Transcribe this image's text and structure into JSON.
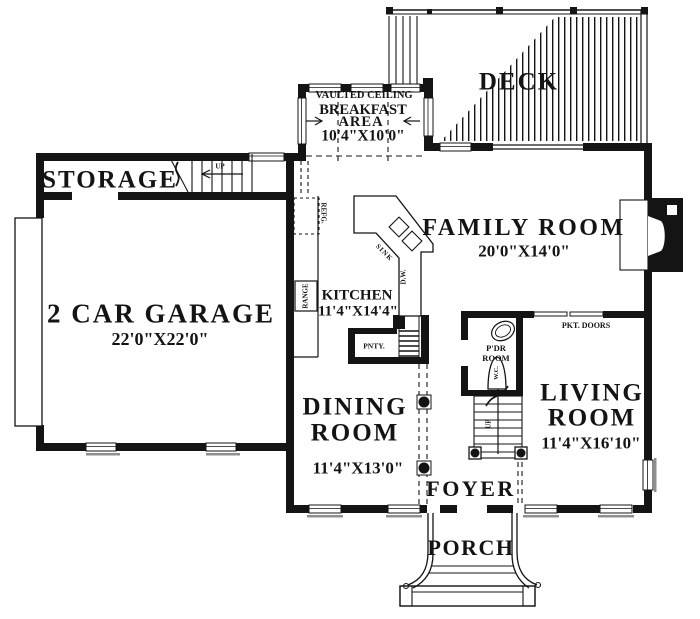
{
  "rooms": {
    "deck": {
      "name": "DECK"
    },
    "breakfast": {
      "note": "VAULTED CEILING",
      "name_line1": "BREAKFAST",
      "name_line2": "AREA",
      "dims": "10'4\"X10'0\""
    },
    "storage": {
      "name": "STORAGE"
    },
    "garage": {
      "name": "2 CAR GARAGE",
      "dims": "22'0\"X22'0\""
    },
    "family_room": {
      "name": "FAMILY ROOM",
      "dims": "20'0\"X14'0\""
    },
    "kitchen": {
      "name": "KITCHEN",
      "dims": "11'4\"X14'4\""
    },
    "dining_room": {
      "name_line1": "DINING",
      "name_line2": "ROOM",
      "dims": "11'4\"X13'0\""
    },
    "living_room": {
      "name_line1": "LIVING",
      "name_line2": "ROOM",
      "dims": "11'4\"X16'10\""
    },
    "powder_room": {
      "name_line1": "P'DR",
      "name_line2": "ROOM"
    },
    "foyer": {
      "name": "FOYER"
    },
    "porch": {
      "name": "PORCH"
    }
  },
  "fixtures": {
    "refrigerator": "REFG.",
    "range": "RANGE",
    "sink": "SINK",
    "dishwasher": "D.W.",
    "pantry": "PNTY.",
    "water_closet": "W.C.",
    "pocket_doors": "PKT. DOORS"
  },
  "stairs": {
    "storage_up": "UP",
    "main_up": "UP"
  },
  "colors": {
    "ink": "#141414",
    "paper": "#ffffff",
    "sill": "#8f8f8f"
  }
}
